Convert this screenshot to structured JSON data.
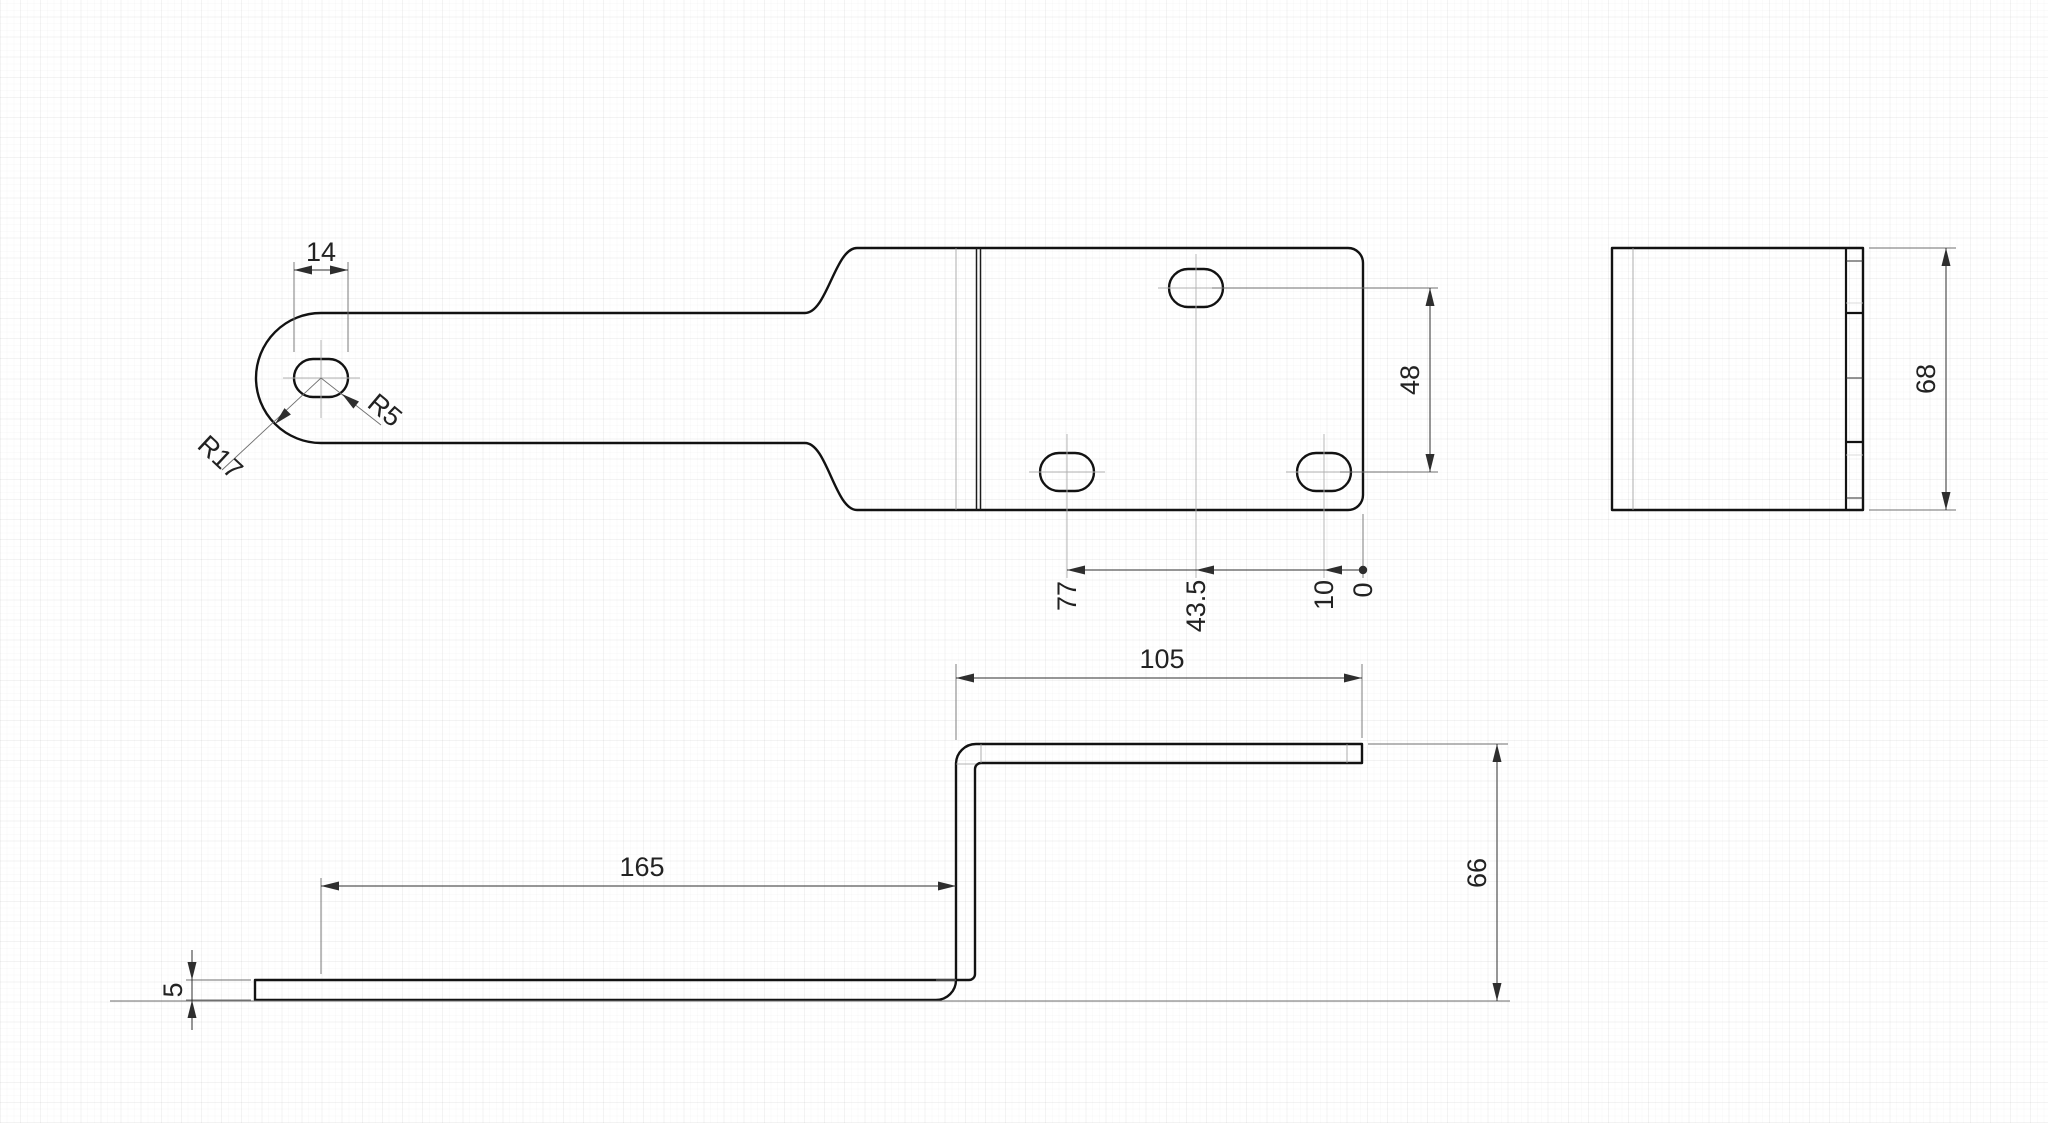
{
  "drawing": {
    "kind": "sheet-metal bracket, three orthographic views",
    "colors": {
      "background": "#ffffff",
      "outline": "#121212",
      "dimension": "#2e2e2e",
      "centerline": "#b0b0b0"
    },
    "views": {
      "plan": {
        "dims": {
          "slot_width": "14",
          "slot_radius": "R5",
          "end_radius": "R17",
          "hole_row_offset": "48",
          "ordinate_hole_left": "77",
          "ordinate_hole_top": "43.5",
          "ordinate_hole_right": "10",
          "ordinate_origin": "0"
        }
      },
      "side": {
        "dims": {
          "width": "68"
        }
      },
      "front": {
        "dims": {
          "top_flange_length": "105",
          "bottom_flange_length": "165",
          "height": "66",
          "thickness": "5"
        }
      }
    }
  }
}
